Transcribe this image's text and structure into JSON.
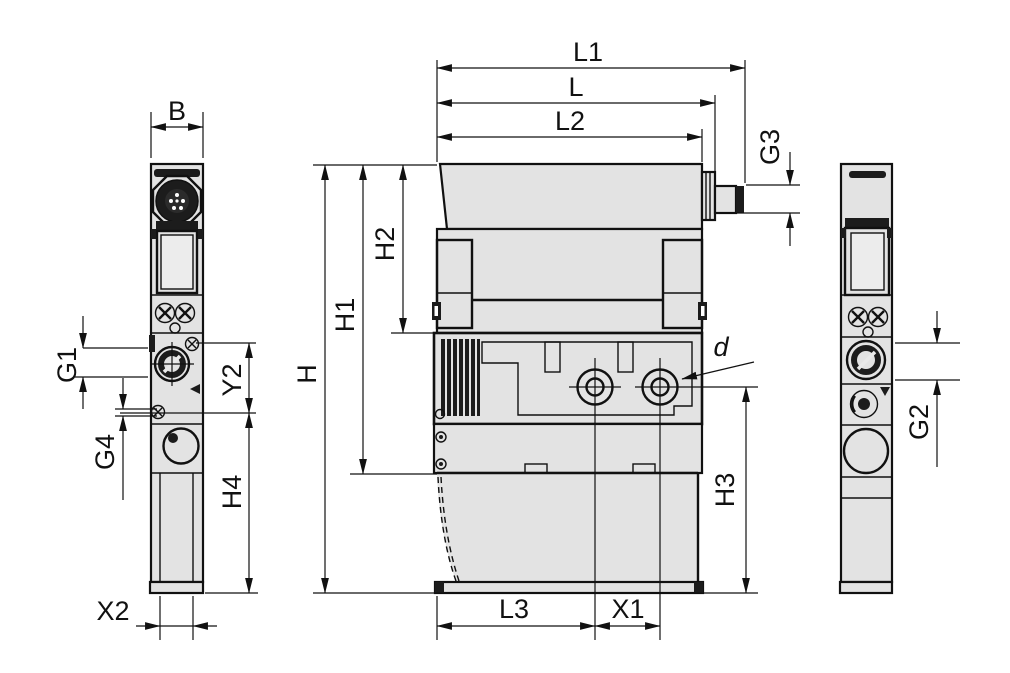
{
  "drawing": {
    "kind": "technical-dimension-drawing",
    "views": [
      {
        "id": "left-side-view",
        "dimensions": [
          "B",
          "G1",
          "G4",
          "Y2",
          "H4",
          "X2"
        ]
      },
      {
        "id": "front-view",
        "dimensions": [
          "L1",
          "L",
          "L2",
          "G3",
          "H",
          "H1",
          "H2",
          "H3",
          "L3",
          "X1",
          "d"
        ]
      },
      {
        "id": "right-side-view",
        "dimensions": [
          "G2"
        ]
      }
    ]
  },
  "labels": {
    "B": "B",
    "G1": "G1",
    "G4": "G4",
    "X2": "X2",
    "Y2": "Y2",
    "H4": "H4",
    "L1": "L1",
    "L": "L",
    "L2": "L2",
    "G3": "G3",
    "H": "H",
    "H1": "H1",
    "H2": "H2",
    "H3": "H3",
    "L3": "L3",
    "X1": "X1",
    "d": "d",
    "G2": "G2"
  },
  "colors": {
    "background": "#ffffff",
    "body_fill": "#e3e3e3",
    "line": "#111111",
    "dark_detail": "#1c1c1c"
  }
}
